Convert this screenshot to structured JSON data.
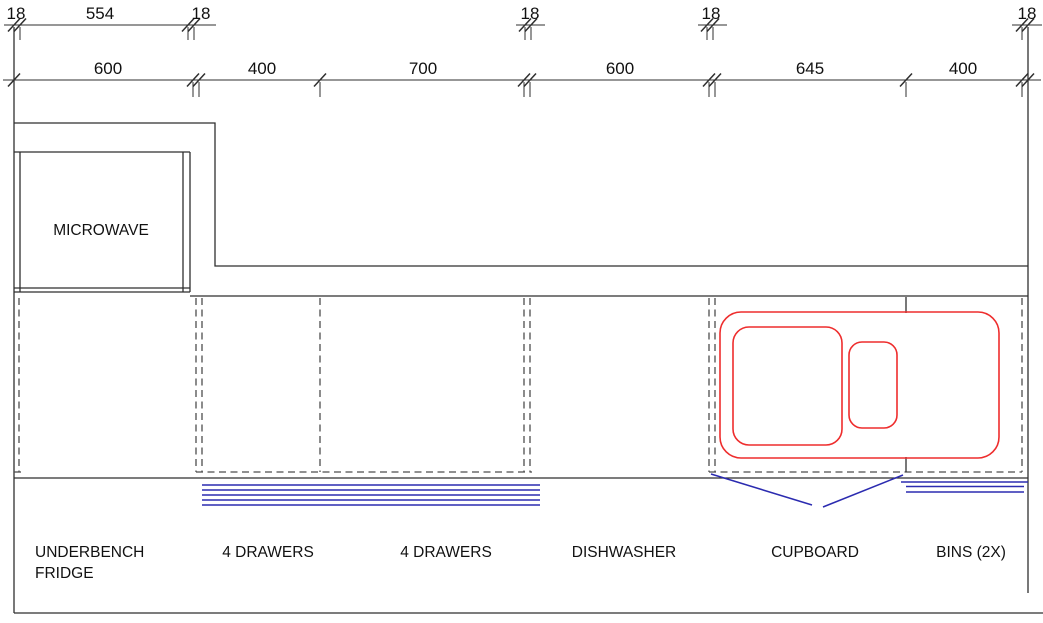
{
  "drawing": {
    "type": "kitchen-cabinetry-elevation",
    "colors": {
      "line": "#2f2f2f",
      "dashed": "#4d4d4d",
      "red": "#ee2d2d",
      "blue": "#2b2bb0",
      "text": "#111111",
      "bg": "#ffffff"
    },
    "panel_thickness_dims": [
      "18",
      "554",
      "18",
      "18",
      "18",
      "18"
    ],
    "cabinet_width_dims": [
      "600",
      "400",
      "700",
      "600",
      "645",
      "400"
    ],
    "labels": {
      "microwave": "MICROWAVE",
      "fridge_line1": "UNDERBENCH",
      "fridge_line2": "FRIDGE",
      "drawers_left": "4 DRAWERS",
      "drawers_right": "4 DRAWERS",
      "dishwasher": "DISHWASHER",
      "cupboard": "CUPBOARD",
      "bins": "BINS (2X)"
    }
  }
}
